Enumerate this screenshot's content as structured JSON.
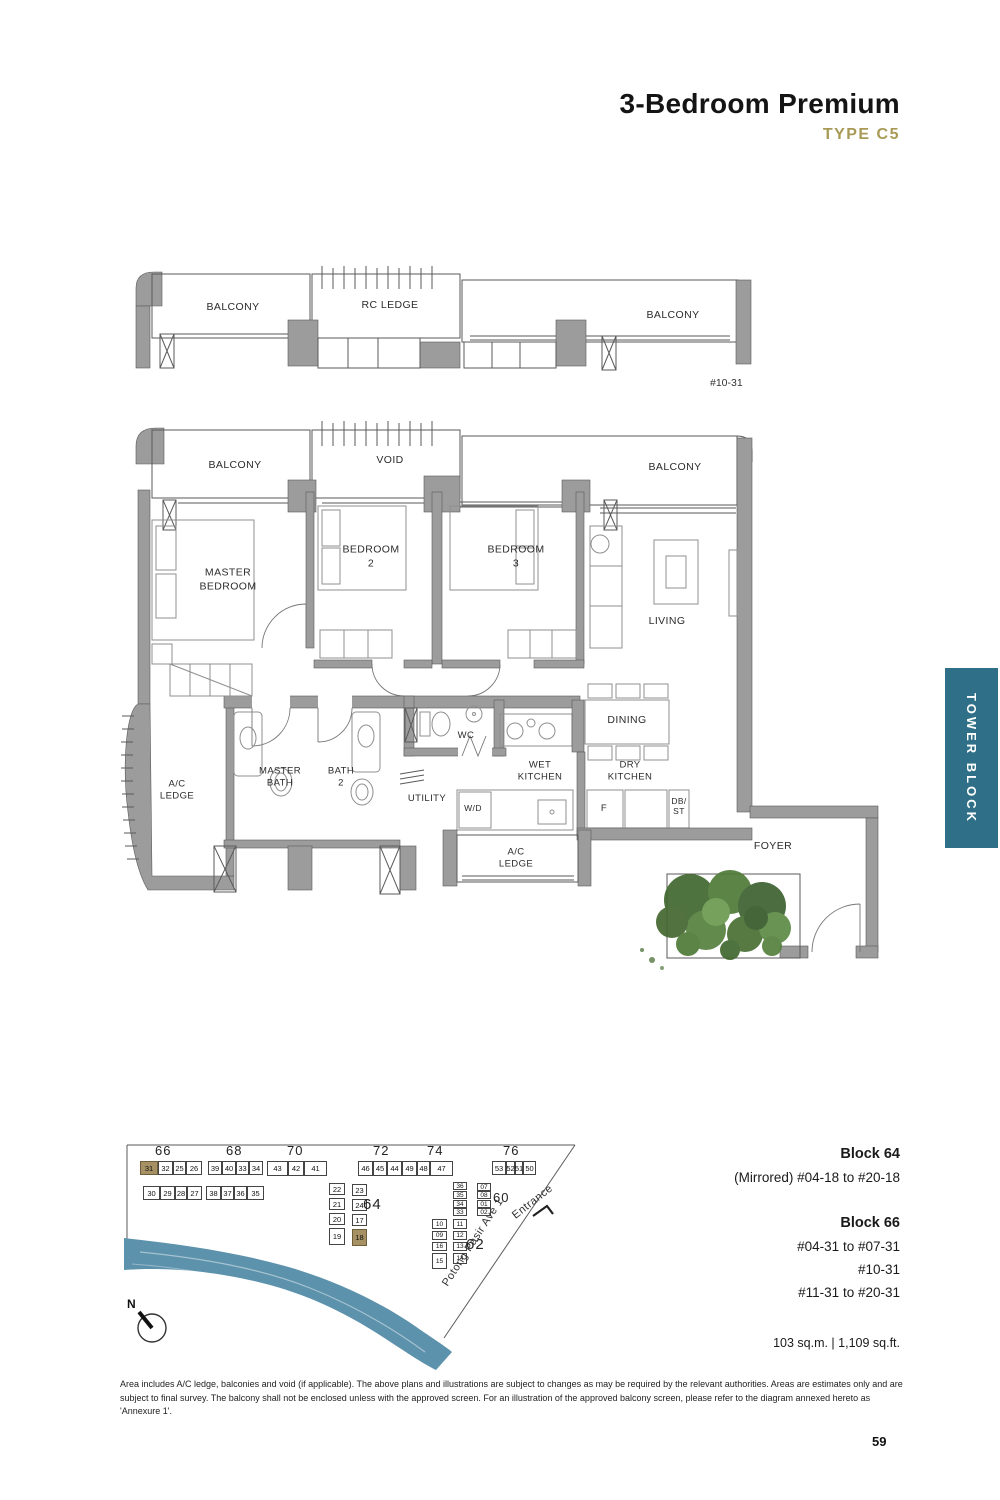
{
  "header": {
    "title": "3-Bedroom Premium",
    "subtitle": "TYPE C5",
    "accent_color": "#a89a56"
  },
  "upper_plan": {
    "balcony_left": "BALCONY",
    "rc_ledge": "RC LEDGE",
    "balcony_right": "BALCONY",
    "floor_tag": "#10-31"
  },
  "floor_plan": {
    "balcony_left": "BALCONY",
    "void": "VOID",
    "balcony_right": "BALCONY",
    "master_bedroom": "MASTER\nBEDROOM",
    "bedroom2": "BEDROOM\n2",
    "bedroom3": "BEDROOM\n3",
    "living": "LIVING",
    "dining": "DINING",
    "wc": "WC",
    "master_bath": "MASTER\nBATH",
    "bath2": "BATH\n2",
    "ac_ledge_left": "A/C\nLEDGE",
    "utility": "UTILITY",
    "wd": "W/D",
    "wet_kitchen": "WET\nKITCHEN",
    "dry_kitchen": "DRY\nKITCHEN",
    "fridge": "F",
    "db_st": "DB/\nST",
    "ac_ledge_bottom": "A/C\nLEDGE",
    "foyer": "FOYER"
  },
  "tower_tab": {
    "label": "TOWER BLOCK",
    "color": "#2f7088"
  },
  "site_plan": {
    "river_label": "Kallang River",
    "road_label": "Potong Pasir Ave 1",
    "entrance_label": "Entrance",
    "north_label": "N",
    "river_color": "#5d92ac",
    "highlight_color": "#a59163",
    "highlighted_units": [
      "31",
      "18"
    ],
    "block_labels": [
      {
        "t": "66",
        "x": 155,
        "y": 1143,
        "fs": 13
      },
      {
        "t": "68",
        "x": 226,
        "y": 1143,
        "fs": 13
      },
      {
        "t": "70",
        "x": 287,
        "y": 1143,
        "fs": 13
      },
      {
        "t": "72",
        "x": 373,
        "y": 1143,
        "fs": 13
      },
      {
        "t": "74",
        "x": 427,
        "y": 1143,
        "fs": 13
      },
      {
        "t": "76",
        "x": 503,
        "y": 1143,
        "fs": 13
      },
      {
        "t": "64",
        "x": 363,
        "y": 1196,
        "fs": 15
      },
      {
        "t": "60",
        "x": 493,
        "y": 1190,
        "fs": 13
      },
      {
        "t": "62",
        "x": 466,
        "y": 1236,
        "fs": 15
      }
    ],
    "units": [
      {
        "t": "31",
        "x": 140,
        "y": 1161,
        "w": 18,
        "h": 14,
        "hl": true
      },
      {
        "t": "32",
        "x": 158,
        "y": 1161,
        "w": 15,
        "h": 14
      },
      {
        "t": "25",
        "x": 173,
        "y": 1161,
        "w": 13,
        "h": 14
      },
      {
        "t": "26",
        "x": 186,
        "y": 1161,
        "w": 16,
        "h": 14
      },
      {
        "t": "30",
        "x": 143,
        "y": 1186,
        "w": 17,
        "h": 14
      },
      {
        "t": "29",
        "x": 160,
        "y": 1186,
        "w": 15,
        "h": 14
      },
      {
        "t": "28",
        "x": 175,
        "y": 1186,
        "w": 12,
        "h": 14
      },
      {
        "t": "27",
        "x": 187,
        "y": 1186,
        "w": 15,
        "h": 14
      },
      {
        "t": "39",
        "x": 208,
        "y": 1161,
        "w": 14,
        "h": 14
      },
      {
        "t": "40",
        "x": 222,
        "y": 1161,
        "w": 14,
        "h": 14
      },
      {
        "t": "33",
        "x": 236,
        "y": 1161,
        "w": 13,
        "h": 14
      },
      {
        "t": "34",
        "x": 249,
        "y": 1161,
        "w": 14,
        "h": 14
      },
      {
        "t": "38",
        "x": 206,
        "y": 1186,
        "w": 15,
        "h": 14
      },
      {
        "t": "37",
        "x": 221,
        "y": 1186,
        "w": 13,
        "h": 14
      },
      {
        "t": "36",
        "x": 234,
        "y": 1186,
        "w": 13,
        "h": 14
      },
      {
        "t": "35",
        "x": 247,
        "y": 1186,
        "w": 17,
        "h": 14
      },
      {
        "t": "43",
        "x": 267,
        "y": 1161,
        "w": 21,
        "h": 15
      },
      {
        "t": "42",
        "x": 288,
        "y": 1161,
        "w": 16,
        "h": 15
      },
      {
        "t": "41",
        "x": 304,
        "y": 1161,
        "w": 23,
        "h": 15
      },
      {
        "t": "46",
        "x": 358,
        "y": 1161,
        "w": 15,
        "h": 15
      },
      {
        "t": "45",
        "x": 373,
        "y": 1161,
        "w": 14,
        "h": 15
      },
      {
        "t": "44",
        "x": 387,
        "y": 1161,
        "w": 15,
        "h": 15
      },
      {
        "t": "49",
        "x": 402,
        "y": 1161,
        "w": 15,
        "h": 15
      },
      {
        "t": "48",
        "x": 417,
        "y": 1161,
        "w": 13,
        "h": 15
      },
      {
        "t": "47",
        "x": 430,
        "y": 1161,
        "w": 23,
        "h": 15
      },
      {
        "t": "53",
        "x": 492,
        "y": 1161,
        "w": 14,
        "h": 14
      },
      {
        "t": "52",
        "x": 506,
        "y": 1161,
        "w": 9,
        "h": 14
      },
      {
        "t": "51",
        "x": 515,
        "y": 1161,
        "w": 8,
        "h": 14
      },
      {
        "t": "50",
        "x": 523,
        "y": 1161,
        "w": 13,
        "h": 14
      },
      {
        "t": "22",
        "x": 329,
        "y": 1183,
        "w": 16,
        "h": 12
      },
      {
        "t": "21",
        "x": 329,
        "y": 1198,
        "w": 16,
        "h": 12
      },
      {
        "t": "20",
        "x": 329,
        "y": 1213,
        "w": 16,
        "h": 12
      },
      {
        "t": "19",
        "x": 329,
        "y": 1228,
        "w": 16,
        "h": 17
      },
      {
        "t": "23",
        "x": 352,
        "y": 1184,
        "w": 15,
        "h": 12
      },
      {
        "t": "24",
        "x": 352,
        "y": 1199,
        "w": 15,
        "h": 12
      },
      {
        "t": "17",
        "x": 352,
        "y": 1214,
        "w": 15,
        "h": 12
      },
      {
        "t": "18",
        "x": 352,
        "y": 1229,
        "w": 15,
        "h": 17,
        "hl": true
      },
      {
        "t": "36",
        "x": 453,
        "y": 1182,
        "w": 14,
        "h": 8,
        "s": true
      },
      {
        "t": "35",
        "x": 453,
        "y": 1191,
        "w": 14,
        "h": 8,
        "s": true
      },
      {
        "t": "34",
        "x": 453,
        "y": 1200,
        "w": 14,
        "h": 8,
        "s": true
      },
      {
        "t": "33",
        "x": 453,
        "y": 1208,
        "w": 14,
        "h": 8,
        "s": true
      },
      {
        "t": "07",
        "x": 477,
        "y": 1183,
        "w": 14,
        "h": 8,
        "s": true
      },
      {
        "t": "08",
        "x": 477,
        "y": 1191,
        "w": 14,
        "h": 8,
        "s": true
      },
      {
        "t": "01",
        "x": 477,
        "y": 1200,
        "w": 14,
        "h": 8,
        "s": true
      },
      {
        "t": "02",
        "x": 477,
        "y": 1208,
        "w": 14,
        "h": 8,
        "s": true
      },
      {
        "t": "10",
        "x": 432,
        "y": 1219,
        "w": 15,
        "h": 10,
        "s": true
      },
      {
        "t": "09",
        "x": 432,
        "y": 1231,
        "w": 15,
        "h": 9,
        "s": true
      },
      {
        "t": "16",
        "x": 432,
        "y": 1242,
        "w": 15,
        "h": 9,
        "s": true
      },
      {
        "t": "15",
        "x": 432,
        "y": 1253,
        "w": 15,
        "h": 16,
        "s": true
      },
      {
        "t": "11",
        "x": 453,
        "y": 1219,
        "w": 14,
        "h": 10,
        "s": true
      },
      {
        "t": "12",
        "x": 453,
        "y": 1231,
        "w": 14,
        "h": 9,
        "s": true
      },
      {
        "t": "13",
        "x": 453,
        "y": 1242,
        "w": 14,
        "h": 9,
        "s": true
      },
      {
        "t": "14",
        "x": 453,
        "y": 1253,
        "w": 14,
        "h": 11,
        "s": true
      }
    ]
  },
  "info": {
    "block64_title": "Block 64",
    "block64_line": "(Mirrored) #04-18 to #20-18",
    "block66_title": "Block 66",
    "block66_lines": [
      "#04-31 to #07-31",
      "#10-31",
      "#11-31 to #20-31"
    ],
    "area_line": "103 sq.m.   |   1,109 sq.ft."
  },
  "footer": {
    "disclaimer": "Area includes A/C ledge, balconies and void (if applicable). The above plans and illustrations are subject to changes as may be required by the relevant authorities. Areas are estimates only and are subject to final survey. The balcony shall not be enclosed unless with the approved screen. For an illustration of the approved balcony screen, please refer to the diagram annexed hereto as 'Annexure 1'.",
    "page_number": "59"
  }
}
